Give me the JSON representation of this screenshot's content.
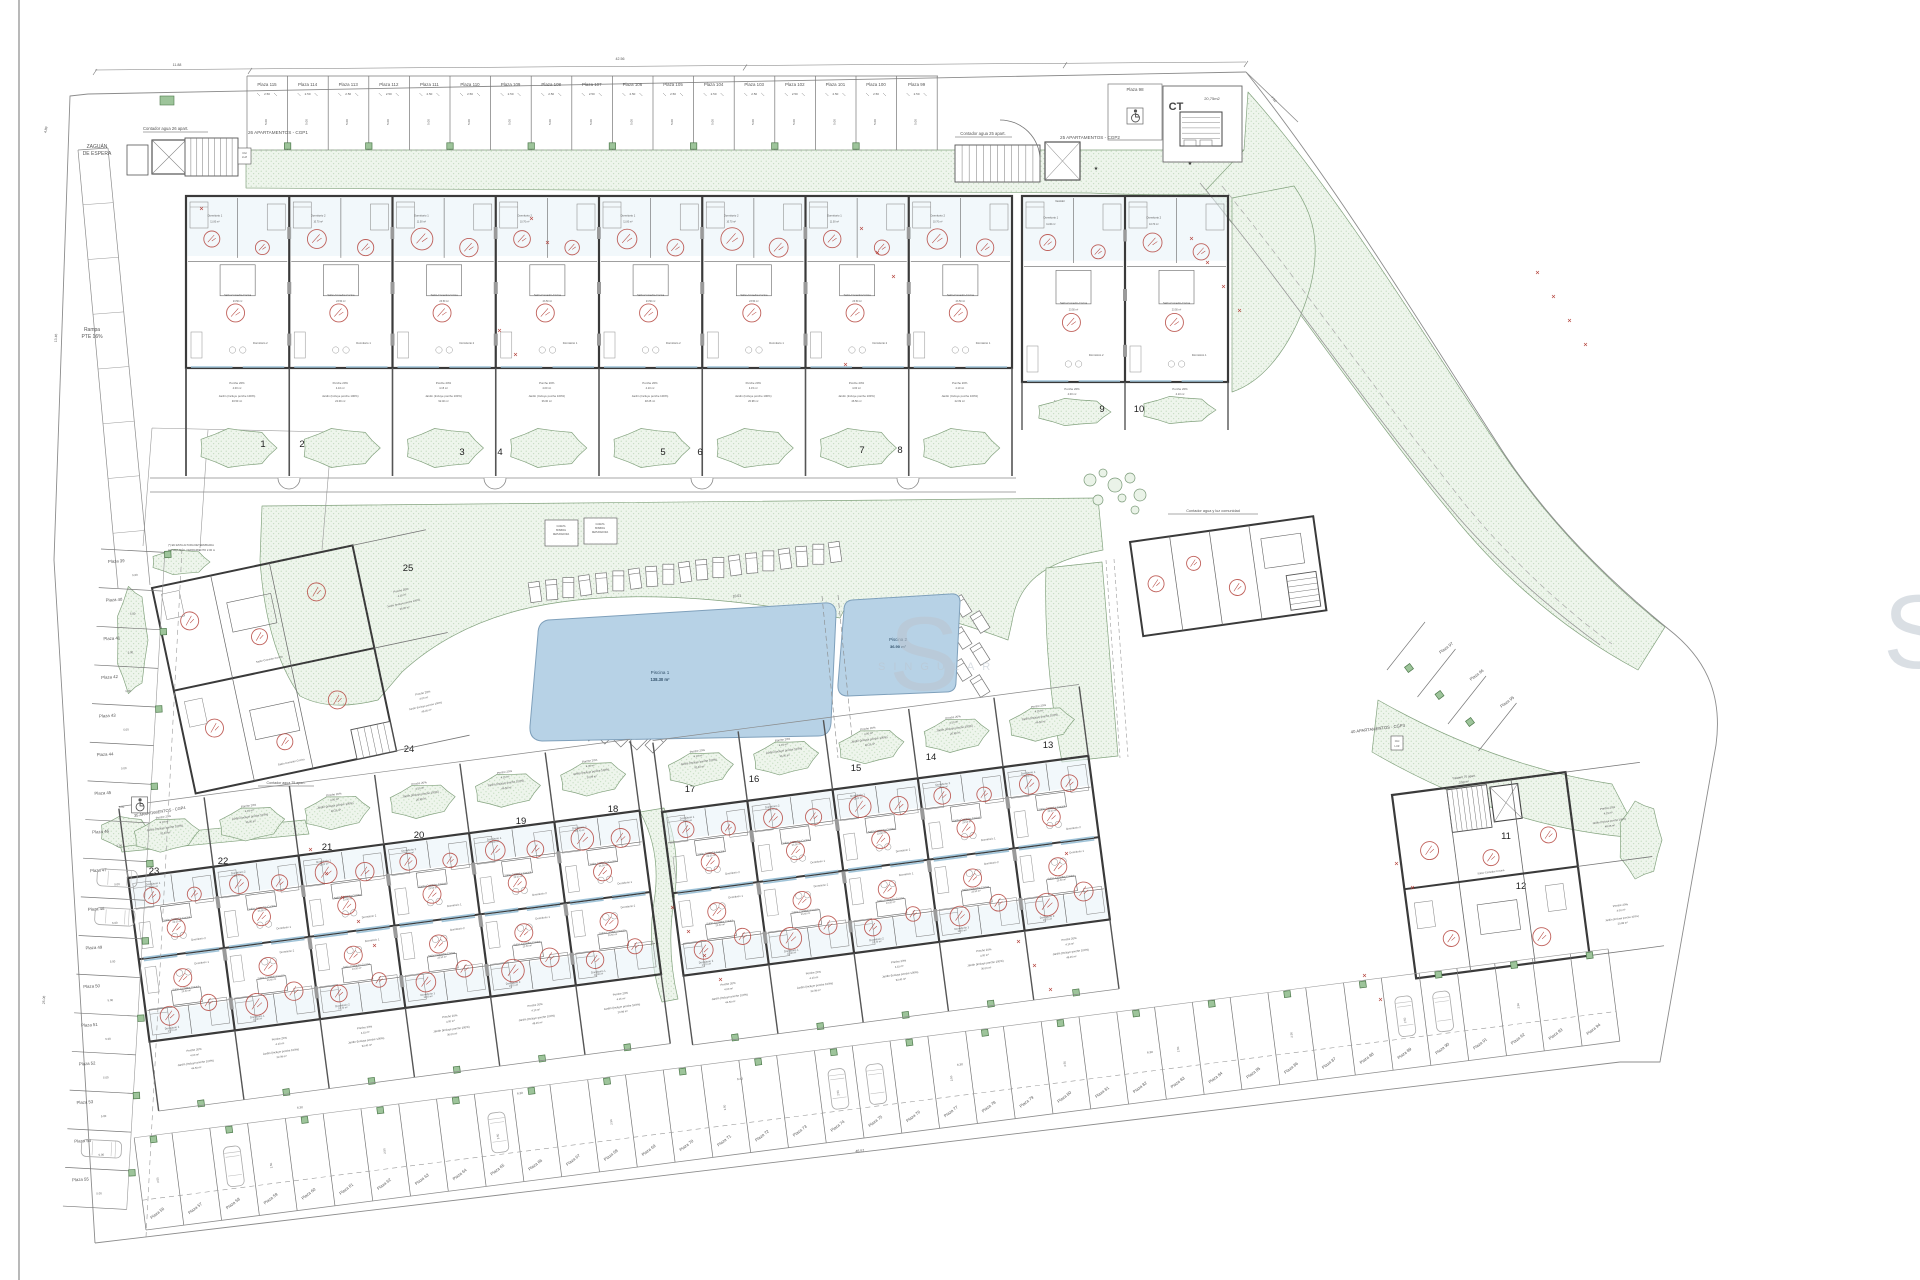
{
  "title": "Plano de conjunto - urbanización con piscinas y aparcamientos",
  "watermark": {
    "big_letter": "S",
    "word": "SINGULAR"
  },
  "colors": {
    "wall": "#3a3a3a",
    "thin": "#6e6e6e",
    "dim": "#555555",
    "red": "#b5453e",
    "green_line": "#84a37f",
    "green_dot": "#b5d2b0",
    "green_fill": "#eef5ec",
    "pool_fill": "#b7d2e6",
    "pool_stroke": "#7fa0bb",
    "glass": "#9fc3d8",
    "planter_fill": "#9dc49a",
    "planter_stroke": "#4e7a4c",
    "watermark": "#bcc5cf"
  },
  "labels": {
    "zaguan_1": "ZAGUÁN",
    "zaguan_2": "DE ESPERA",
    "rampa_1": "Rampa",
    "rampa_2": "PTE 16%",
    "contador26": "Contador agua 26 apart.",
    "contador25": "Contador agua 25 apart.",
    "contador75": "Contador agua 75 apart.",
    "contador_com": "Contador agua y luz comunidad",
    "apt26": "26 APARTAMENTOS - CGP1",
    "apt25": "25 APARTAMENTOS - CGP2",
    "apt40": "40 APARTAMENTOS - CGP3",
    "apt35": "35 APARTAMENTOS - CGP4",
    "trastero_1": "Trastero 75 apart.",
    "trastero_2": "3.90 m²",
    "ct": "CT",
    "ct_area": "20,75m2",
    "cgi_1": "CGI",
    "cgi_2": "LUZ",
    "note_1": "(*) EN ESTA ALTURA DETERMINADA",
    "note_2": "ALTURA MÁX. CERRAMIENTO 2.00 m",
    "caseta_1": "CASETA",
    "caseta_2": "BOMBAS",
    "caseta_3": "DEPURADORA",
    "jardinera": "Jardinera 2.00 m²"
  },
  "pools": [
    {
      "name": "Piscina 1",
      "area": "138.30 m²"
    },
    {
      "name": "Piscina 2",
      "area": "36.90 m²"
    }
  ],
  "units": {
    "numbers": [
      "1",
      "2",
      "3",
      "4",
      "5",
      "6",
      "7",
      "8",
      "9",
      "10",
      "11",
      "12",
      "13",
      "14",
      "15",
      "16",
      "17",
      "18",
      "19",
      "20",
      "21",
      "22",
      "23",
      "24",
      "25"
    ]
  },
  "parking": {
    "top_row": [
      "Plaza 115",
      "Plaza 114",
      "Plaza 113",
      "Plaza 112",
      "Plaza 111",
      "Plaza 110",
      "Plaza 109",
      "Plaza 108",
      "Plaza 107",
      "Plaza 106",
      "Plaza 105",
      "Plaza 104",
      "Plaza 103",
      "Plaza 102",
      "Plaza 101",
      "Plaza 100",
      "Plaza 99"
    ],
    "accessible_top": "Plaza 98",
    "left_col": [
      "Plaza 39",
      "Plaza 40",
      "Plaza 41",
      "Plaza 42",
      "Plaza 43",
      "Plaza 44",
      "Plaza 45",
      "Plaza 46",
      "Plaza 47",
      "Plaza 48",
      "Plaza 49",
      "Plaza 50",
      "Plaza 51",
      "Plaza 52",
      "Plaza 53",
      "Plaza 54",
      "Plaza 55"
    ],
    "bottom_row": [
      "Plaza 56",
      "Plaza 57",
      "Plaza 58",
      "Plaza 59",
      "Plaza 60",
      "Plaza 61",
      "Plaza 62",
      "Plaza 63",
      "Plaza 64",
      "Plaza 65",
      "Plaza 66",
      "Plaza 67",
      "Plaza 68",
      "Plaza 69",
      "Plaza 70",
      "Plaza 71",
      "Plaza 72",
      "Plaza 73",
      "Plaza 74",
      "Plaza 75",
      "Plaza 76",
      "Plaza 77",
      "Plaza 78",
      "Plaza 79",
      "Plaza 80",
      "Plaza 81",
      "Plaza 82",
      "Plaza 83",
      "Plaza 84",
      "Plaza 85",
      "Plaza 86",
      "Plaza 87",
      "Plaza 88",
      "Plaza 89",
      "Plaza 90",
      "Plaza 91",
      "Plaza 92",
      "Plaza 93",
      "Plaza 94"
    ],
    "right_curve": [
      "Plaza 97",
      "Plaza 96",
      "Plaza 95"
    ]
  },
  "rooms": {
    "names": [
      "Dormitorio 1",
      "Dormitorio 2",
      "Baño 1",
      "Baño 2",
      "Paso",
      "Salón-Comedor-Cocina",
      "Vestidor",
      "Dormitorio 3"
    ],
    "areas": [
      "11.00 m²",
      "10.70 m²",
      "3.90 m²",
      "3.60 m²",
      "4.00 m²",
      "23.50 m²",
      "11.50 m²",
      "9.00 m²"
    ]
  },
  "garden": {
    "porche": "Porche 20%",
    "porche_areas": [
      "4.00 m²",
      "4.10 m²",
      "4.15 m²"
    ],
    "jardin": "Jardín (Incluye porche 100%)",
    "jardin_areas": [
      "46.50 m²",
      "22.09 m²",
      "92.40 m²",
      "36.00 m²",
      "48.25 m²",
      "20.98 m²"
    ]
  },
  "dims": [
    "2.50",
    "5.00",
    "6.30",
    "6.31",
    "6.44",
    "6.45",
    "11.88",
    "42.56",
    "7.52",
    "3.88",
    "23.96",
    "10.01",
    "46.57",
    "13.46",
    "25.08",
    "4.89",
    "2.38",
    "1.40",
    "8.11",
    "2.00"
  ]
}
